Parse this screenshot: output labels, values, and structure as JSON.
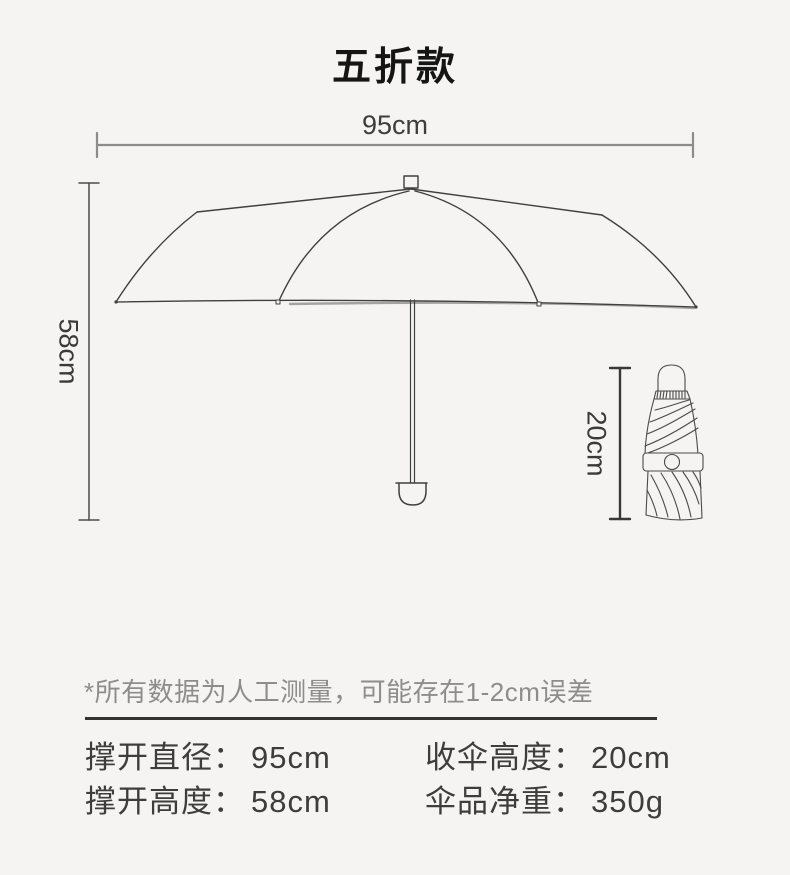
{
  "title": "五折款",
  "dimension_labels": {
    "open_width": "95cm",
    "open_height": "58cm",
    "folded_height": "20cm"
  },
  "disclaimer": "*所有数据为人工测量，可能存在1-2cm误差",
  "specs": {
    "rows": [
      {
        "left": {
          "label": "撑开直径：",
          "value": "95cm"
        },
        "right": {
          "label": "收伞高度：",
          "value": "20cm"
        }
      },
      {
        "left": {
          "label": "撑开高度：",
          "value": "58cm"
        },
        "right": {
          "label": "伞品净重：",
          "value": "350g"
        }
      }
    ]
  },
  "colors": {
    "background": "#f5f4f2",
    "line_art": "#3f3f3f",
    "dimension_gray": "#8c8c8c",
    "dimension_dark": "#383838",
    "text_dark": "#3d3d3d",
    "disclaimer_gray": "#8d8d8d",
    "divider": "#333333"
  }
}
